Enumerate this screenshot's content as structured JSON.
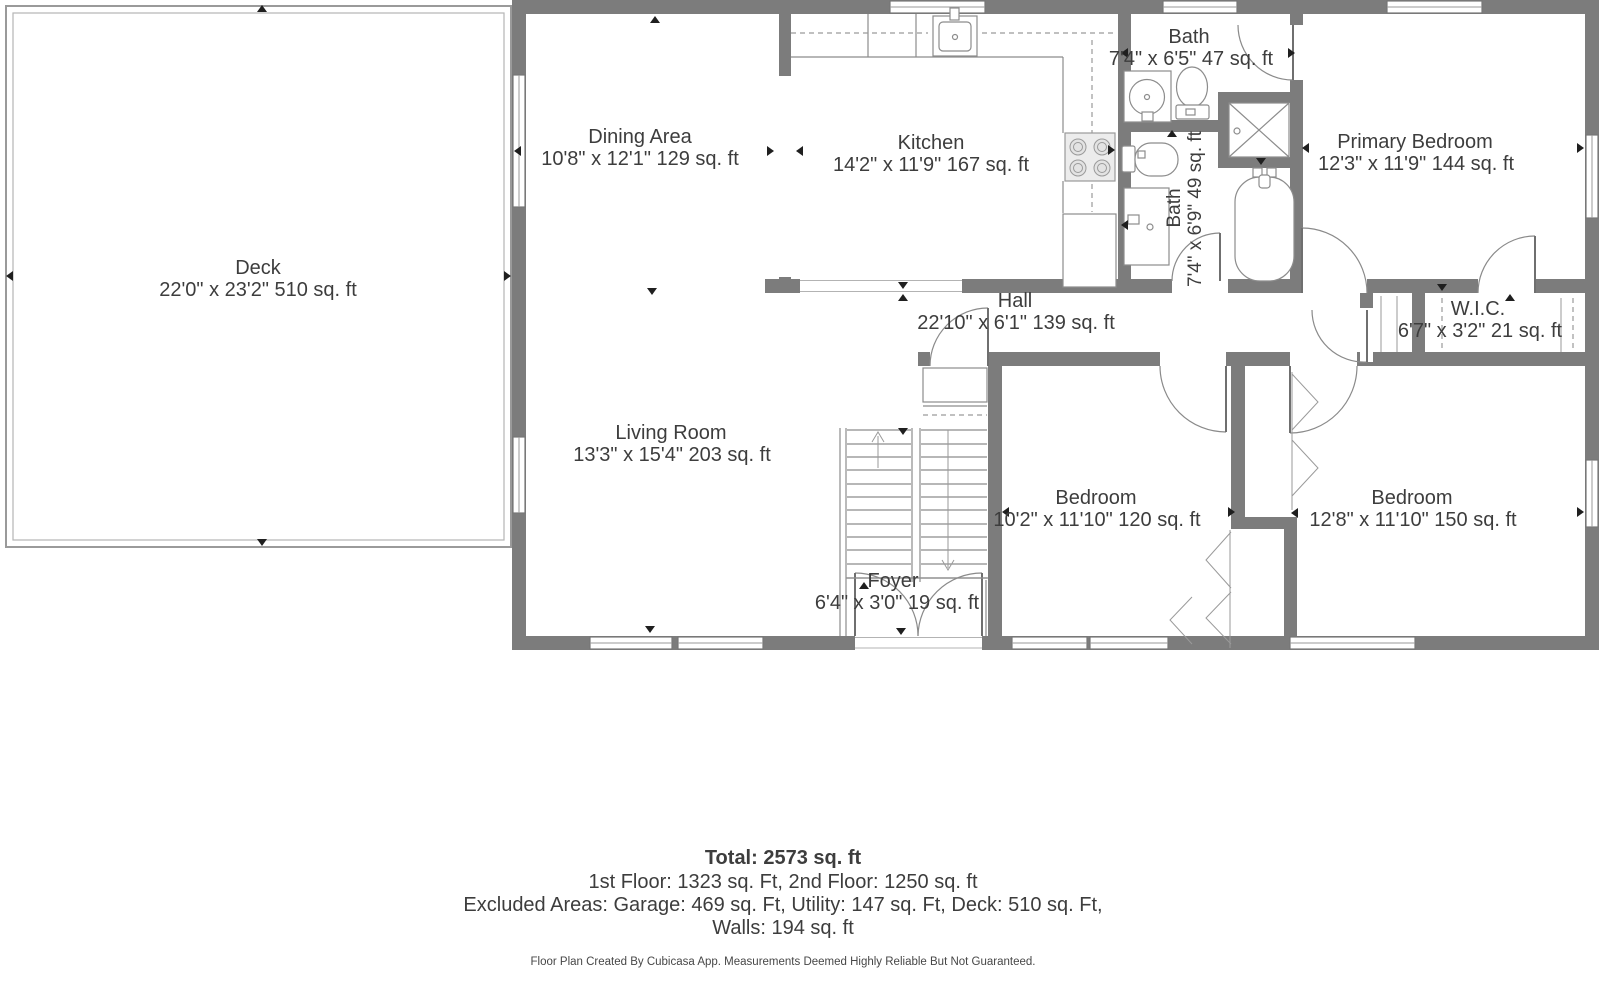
{
  "colors": {
    "wall": "#7c7c7c",
    "thin_line": "#8c8c8c",
    "dashed_line": "#9a9a9a",
    "text": "#3d3d3d",
    "background": "#ffffff"
  },
  "rooms": {
    "deck": {
      "name": "Deck",
      "dims": "22'0\" x 23'2\" 510 sq. ft"
    },
    "dining_area": {
      "name": "Dining Area",
      "dims": "10'8\" x 12'1\" 129 sq. ft"
    },
    "kitchen": {
      "name": "Kitchen",
      "dims": "14'2\" x 11'9\" 167 sq. ft"
    },
    "bath_upper": {
      "name": "Bath",
      "dims": "7'4\" x 6'5\" 47 sq. ft"
    },
    "bath_lower": {
      "name": "Bath",
      "dims": "7'4\" x 6'9\" 49 sq. ft"
    },
    "primary_bedroom": {
      "name": "Primary Bedroom",
      "dims": "12'3\" x 11'9\" 144 sq. ft"
    },
    "hall": {
      "name": "Hall",
      "dims": "22'10\" x 6'1\" 139 sq. ft"
    },
    "wic": {
      "name": "W.I.C.",
      "dims": "6'7\" x 3'2\" 21 sq. ft"
    },
    "living_room": {
      "name": "Living Room",
      "dims": "13'3\" x 15'4\" 203 sq. ft"
    },
    "bedroom_mid": {
      "name": "Bedroom",
      "dims": "10'2\" x 11'10\" 120 sq. ft"
    },
    "bedroom_right": {
      "name": "Bedroom",
      "dims": "12'8\" x 11'10\" 150 sq. ft"
    },
    "foyer": {
      "name": "Foyer",
      "dims": "6'4\" x 3'0\" 19 sq. ft"
    }
  },
  "summary": {
    "total": "Total: 2573 sq. ft",
    "floors": "1st Floor: 1323 sq. Ft, 2nd Floor: 1250 sq. ft",
    "excluded": "Excluded Areas: Garage: 469 sq. Ft, Utility: 147 sq. Ft, Deck: 510 sq. Ft,",
    "walls": "Walls: 194 sq. ft"
  },
  "footer": "Floor Plan Created By Cubicasa App. Measurements Deemed Highly Reliable But Not Guaranteed."
}
